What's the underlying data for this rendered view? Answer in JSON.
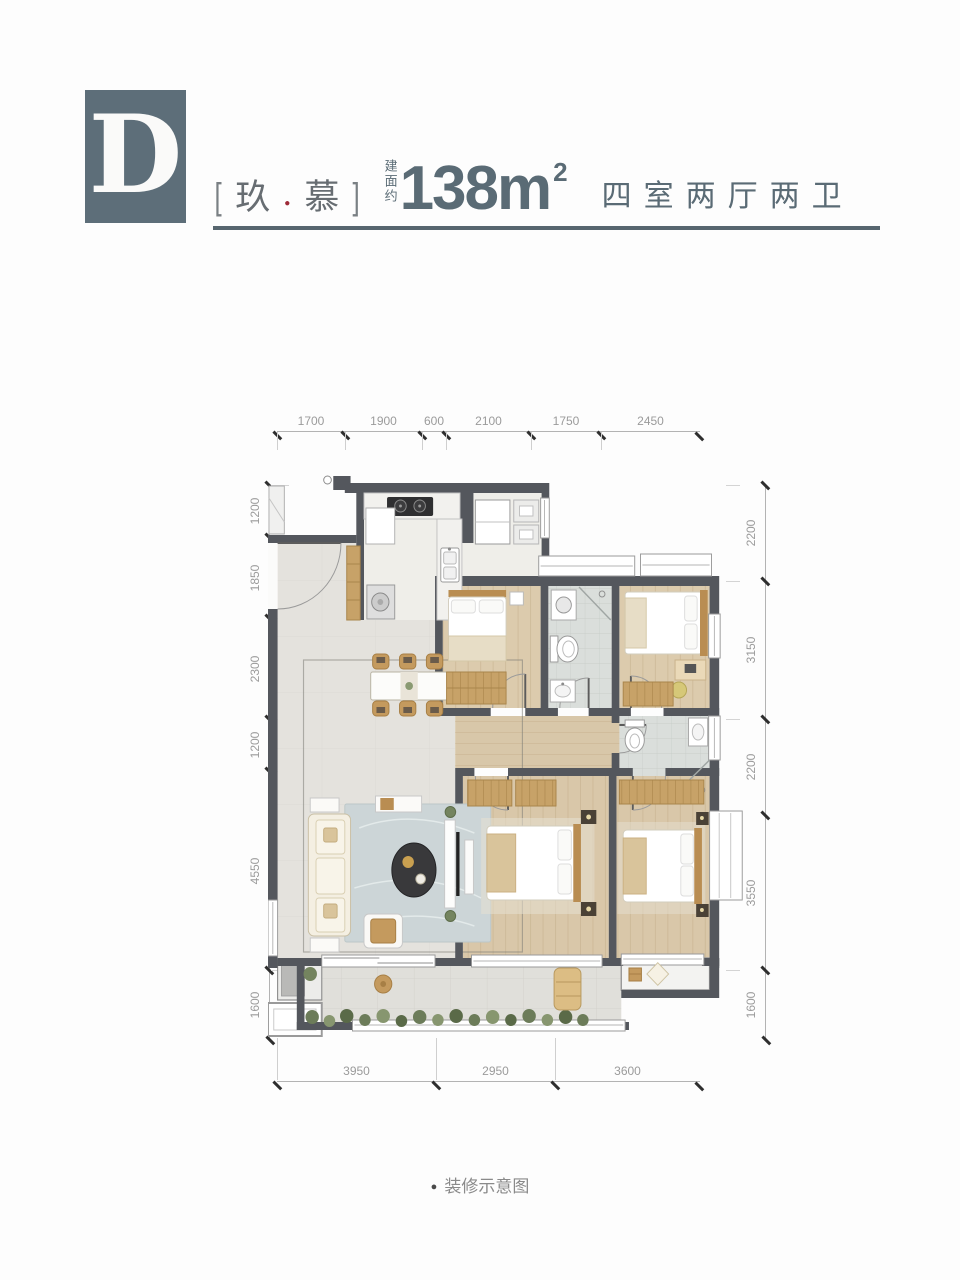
{
  "header": {
    "block_letter": "D",
    "bracket_left": "[",
    "name_char1": "玖",
    "name_separator": "●",
    "name_char2": "慕",
    "bracket_right": "]",
    "area_prefix": "建面约",
    "area_value": "138m",
    "area_superscript": "2",
    "room_config": "四室两厅两卫"
  },
  "dimensions": {
    "top": [
      "1700",
      "1900",
      "600",
      "2100",
      "1750",
      "2450"
    ],
    "bottom": [
      "3950",
      "2950",
      "3600"
    ],
    "left": [
      "1200",
      "1850",
      "2300",
      "1200",
      "4550",
      "1600"
    ],
    "right": [
      "2200",
      "3150",
      "2200",
      "3550",
      "1600"
    ]
  },
  "caption": {
    "bullet": "●",
    "text": "装修示意图"
  },
  "colors": {
    "brand_slate": "#5d6e79",
    "heading_text": "#5a6b75",
    "accent_red": "#9e2b38",
    "wall": "#54575d",
    "dimension_text": "#9b9b9b"
  }
}
